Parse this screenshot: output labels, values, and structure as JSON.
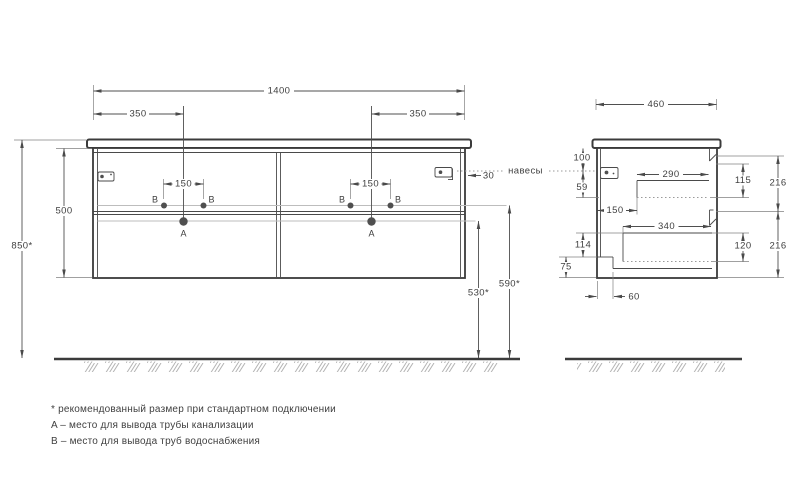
{
  "front_view": {
    "width": "1400",
    "sink_offset_left": "350",
    "sink_offset_right": "350",
    "tap_spacing_left": "150",
    "tap_spacing_right": "150",
    "body_height": "500",
    "mount_height": "850*",
    "hinge_offset": "30",
    "hinges_label": "навесы",
    "supply_height": "590*",
    "drain_height": "530*",
    "point_a": "A",
    "point_b": "B"
  },
  "side_view": {
    "depth": "460",
    "hanger_top_offset": "100",
    "hanger_to_drawer": "59",
    "upper_drawer_depth": "290",
    "upper_drawer_height": "115",
    "upper_front_height": "216",
    "wall_to_drawer": "150",
    "lower_drawer_depth": "340",
    "lower_drawer_height": "120",
    "lower_front_height": "216",
    "drawer_bottom_offset": "114",
    "recess_height": "75",
    "recess_depth": "60"
  },
  "notes": {
    "recommended": "* рекомендованный размер при стандартном подключении",
    "point_a": "A – место для вывода трубы канализации",
    "point_b": "B – место для вывода труб водоснабжения"
  },
  "icons": {
    "hinge_left": "hinge-plate",
    "hinge_right": "hinge-plate",
    "wall_hanger": "hanger-plate"
  },
  "colors": {
    "line": "#3b3b3b",
    "dimension": "#4f4f4f",
    "light_line": "#bdbdbd",
    "hatch": "#b3b3b3",
    "background": "#ffffff"
  }
}
